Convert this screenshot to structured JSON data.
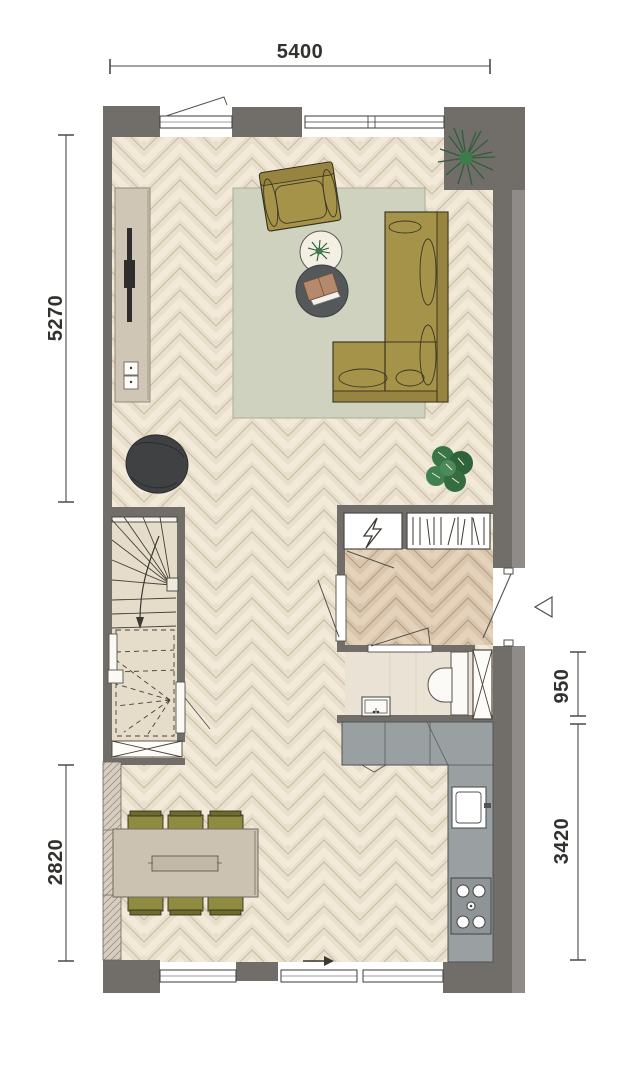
{
  "plan": {
    "dimensions": {
      "top": "5400",
      "left_upper": "5270",
      "left_lower": "2820",
      "right_upper": "950",
      "right_lower": "3420"
    },
    "icons": {
      "lightning_bolt": "⚡",
      "entry_arrow": "→",
      "entry_marker": "◁"
    },
    "colors": {
      "wall": "#716d69",
      "wall_outer": "#8e8b88",
      "party_wall_hatch": "#d8cec0",
      "floor_light": "#e9dfcd",
      "floor_hall": "#d9c5ac",
      "stair_floor": "#e6dcca",
      "toilet_floor": "#eae2d4",
      "rug": "#ced2be",
      "sofa_olive": "#a59349",
      "chair_olive": "#8f8b41",
      "table_beige": "#cbc2b1",
      "tv_cabinet": "#cfc6b5",
      "counter_gray": "#9aa0a1",
      "stove_gray": "#8f9596",
      "pouf_dark": "#3f4143",
      "plant_green": "#3e7c4a",
      "dim_text": "#33312e"
    }
  }
}
